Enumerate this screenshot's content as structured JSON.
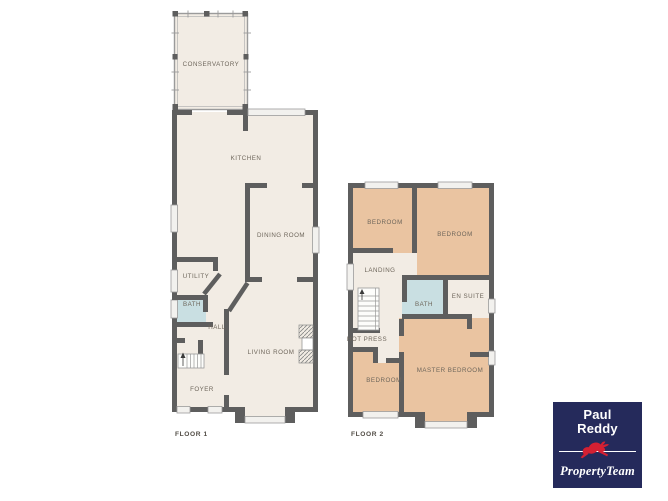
{
  "floor1": {
    "label": "FLOOR 1",
    "rooms": {
      "conservatory": "CONSERVATORY",
      "kitchen": "KITCHEN",
      "dining_room": "DINING ROOM",
      "utility": "UTILITY",
      "bath": "BATH",
      "hall": "HALL",
      "living_room": "LIVING ROOM",
      "foyer": "FOYER"
    }
  },
  "floor2": {
    "label": "FLOOR 2",
    "rooms": {
      "bedroom_top_left": "BEDROOM",
      "bedroom_top_right": "BEDROOM",
      "landing": "LANDING",
      "bath": "BATH",
      "en_suite": "EN SUITE",
      "hot_press": "HOT PRESS",
      "bedroom_bottom_left": "BEDROOM",
      "master_bedroom": "MASTER BEDROOM"
    }
  },
  "logo": {
    "line1": "Paul",
    "line2": "Reddy",
    "tagline": "PropertyTeam",
    "hare_icon": "hare-icon",
    "colors": {
      "background": "#252a5b",
      "hare": "#d42032",
      "text": "#ffffff"
    }
  },
  "colors": {
    "wall": "#5e5e5e",
    "floor_fill": "#f2ece4",
    "bath_fill": "#c9dfe2",
    "bedroom_fill": "#eac4a1",
    "window_fill": "#f2f1ee",
    "label_text": "#6e665b",
    "floor_label_text": "#514c45"
  }
}
